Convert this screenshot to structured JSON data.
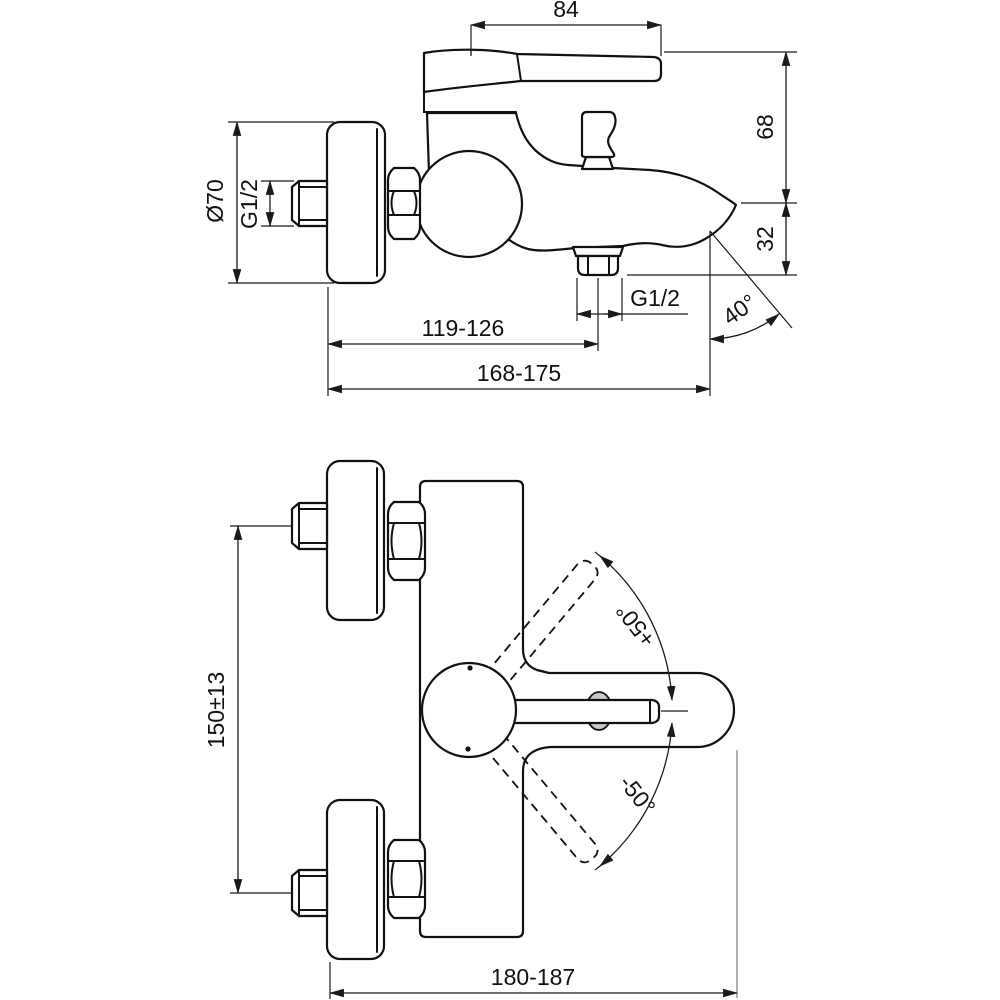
{
  "drawing": {
    "colors": {
      "background": "#ffffff",
      "outline": "#111111",
      "dimension": "#1a1a1a",
      "gray_extension": "#8c8c8c",
      "hub_fill": "#c9c9c9"
    },
    "side_view": {
      "dim_lever_length": "84",
      "dim_height_to_lever": "68",
      "dim_spout_drop": "32",
      "dim_escutcheon_diameter": "Ø70",
      "dim_inlet_thread": "G1/2",
      "dim_wall_to_shower_outlet": "119-126",
      "dim_wall_to_spout_tip": "168-175",
      "dim_spout_angle": "40°",
      "dim_shower_outlet_thread": "G1/2"
    },
    "front_view": {
      "dim_inlet_centres": "150±13",
      "dim_handle_open_up": "+50°",
      "dim_handle_open_down": "-50°",
      "dim_overall_width": "180-187"
    }
  }
}
